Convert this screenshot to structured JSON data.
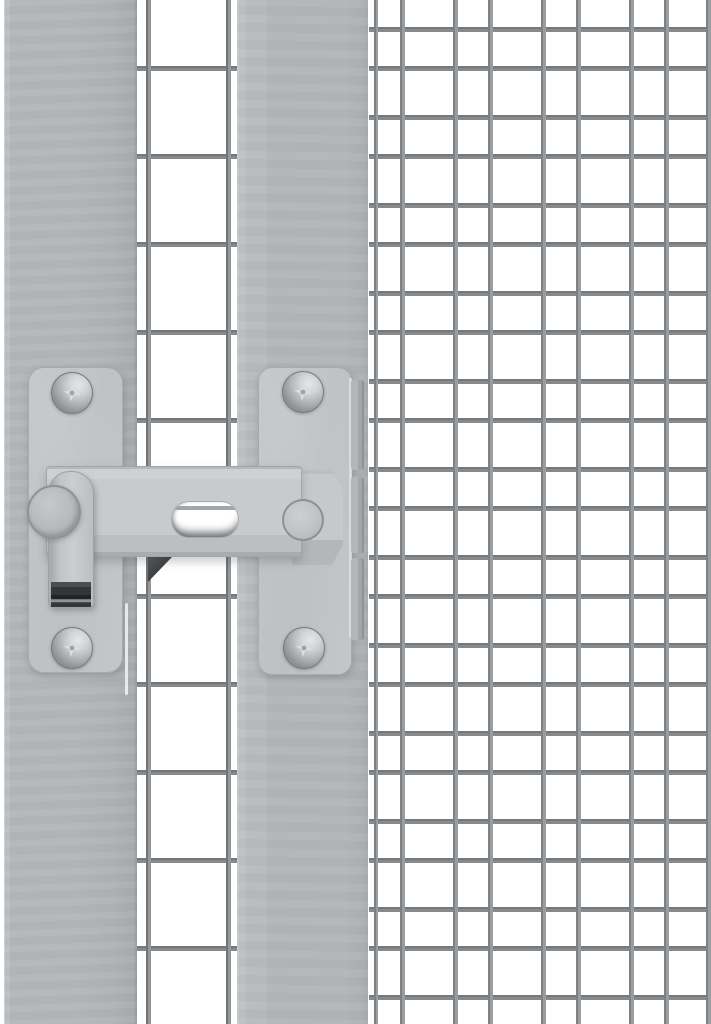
{
  "scene": {
    "type": "product-photo",
    "description": "Close-up of a grey galvanized gate latch with flip handle, mounted between a solid frame post and a fine welded-wire mesh gate panel",
    "text_content": "none"
  },
  "colors": {
    "background": "#ffffff",
    "frame": "#b3b6b8",
    "frame_edge": "#989c9e",
    "plate": "#c2c5c7",
    "bar": "#c8cbcd",
    "wire": "#868a8c",
    "wire_dark": "#6e7274",
    "handle_dark": "#33373a",
    "screw_light": "#e4e7e9",
    "screw_dark": "#7f8385"
  },
  "mesh": {
    "large_mesh_pitch_px": 88,
    "fine_mesh_pitch_px": 44,
    "wire_thickness_px": 5
  },
  "parts": [
    {
      "name": "left-frame-post",
      "label": "solid grey frame post"
    },
    {
      "name": "large-wire-mesh",
      "label": "large-square welded mesh strip"
    },
    {
      "name": "gate-frame-bar",
      "label": "grey gate frame upright"
    },
    {
      "name": "fine-wire-mesh",
      "label": "fine welded wire mesh panel"
    },
    {
      "name": "latch-left-plate",
      "label": "latch mounting plate with flip handle"
    },
    {
      "name": "latch-right-plate",
      "label": "latch catch plate with frame tabs"
    },
    {
      "name": "latch-bar",
      "label": "slotted sliding latch bar"
    },
    {
      "name": "latch-handle",
      "label": "flip handle with dark rubber grip"
    },
    {
      "name": "latch-pivot",
      "label": "round pivot disc"
    },
    {
      "name": "latch-rivet",
      "label": "guide rivet in latch bar end"
    },
    {
      "name": "screws",
      "label": "four phillips pan-head screws"
    }
  ]
}
